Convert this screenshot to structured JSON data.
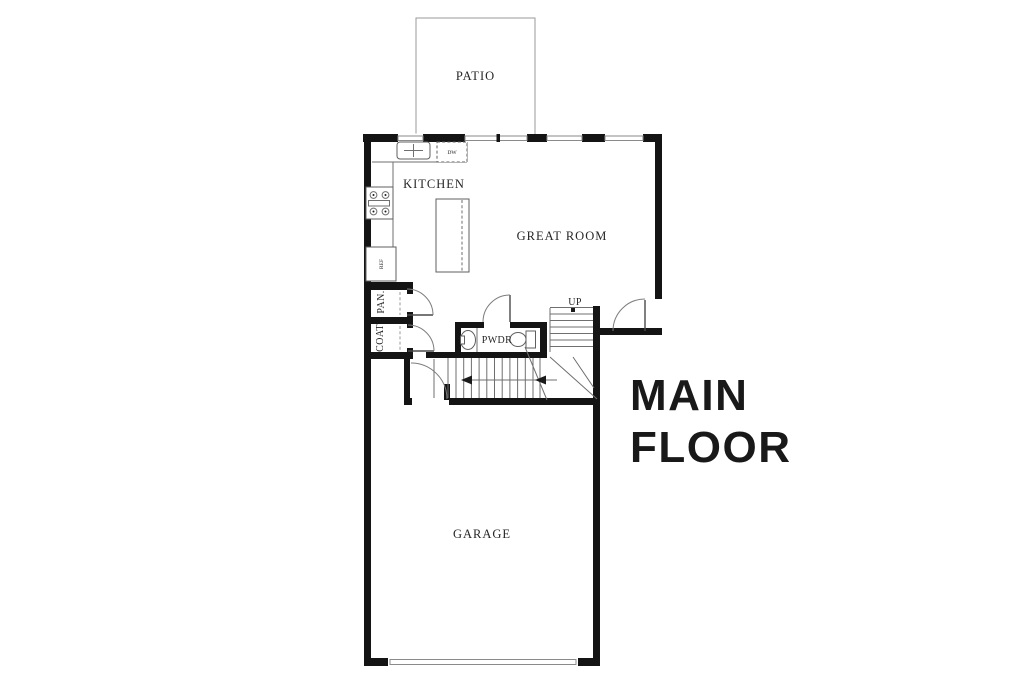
{
  "title": {
    "line1": "MAIN",
    "line2": "FLOOR"
  },
  "rooms": {
    "patio": "PATIO",
    "kitchen": "KITCHEN",
    "great_room": "GREAT ROOM",
    "garage": "GARAGE",
    "powder": "PWDR",
    "pantry": "PAN.",
    "coat": "COAT"
  },
  "annotations": {
    "up": "UP",
    "ref": "REF",
    "dishwasher": "DW"
  },
  "colors": {
    "background": "#ffffff",
    "wall": "#141414",
    "thin_line": "#6f6f6f",
    "light_line": "#9a9a9a",
    "label_text": "#262626",
    "title_text": "#191919"
  }
}
